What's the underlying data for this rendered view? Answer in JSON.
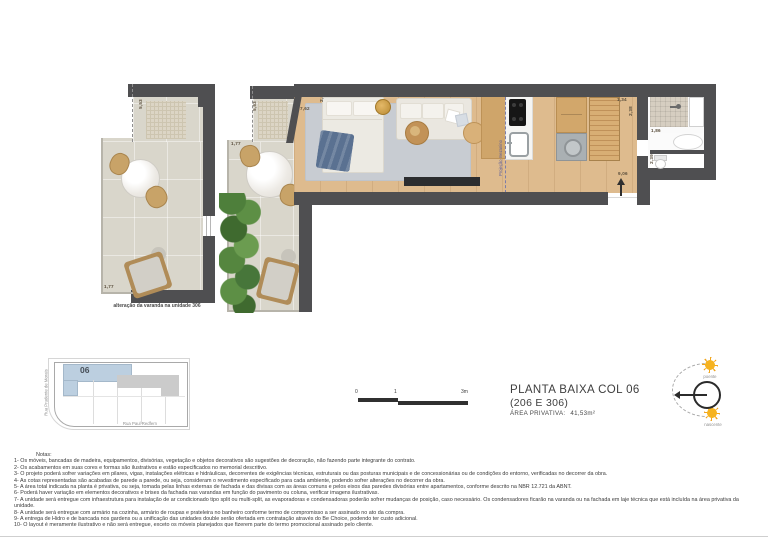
{
  "title_block": {
    "title": "PLANTA BAIXA COL 06",
    "subtitle": "(206 E 306)",
    "area_label": "ÁREA PRIVATIVA:",
    "area_value": "41,53m²"
  },
  "scale_bar": {
    "zero": "0",
    "one": "1",
    "three": "3m"
  },
  "compass": {
    "top_label": "poente",
    "bottom_label": "nascente"
  },
  "site_plan": {
    "unit": "06",
    "street_left": "Rua Prudente de Morais",
    "street_bottom": "Rua Paul Redfern"
  },
  "plan": {
    "balcony_306_caption": "alteração da varanda na unidade 306",
    "mezzanine_label": "Projeção mezanino",
    "dims": {
      "balcony306_depth": "5,53",
      "balcony306_width": "1,77",
      "balcony206_depth": "5,53",
      "balcony206_width": "1,77",
      "living_length": "7,62",
      "living_width": "2,43",
      "bath_width": "1,34",
      "bath_depth": "2,38",
      "vanity_length": "1,86",
      "wc_depth": "2,39",
      "total_length": "9,06"
    }
  },
  "notes": {
    "heading": "Notas:",
    "items": [
      "1- Os móveis, bancadas de madeira, equipamentos, divisórias, vegetação e objetos decorativos são sugestões de decoração, não fazendo parte integrante do contrato.",
      "2- Os acabamentos em suas cores e formas são ilustrativos e estão especificados no memorial descritivo.",
      "3- O projeto poderá sofrer variações em pilares, vigas, instalações elétricas e hidráulicas, decorrentes de exigências técnicas, estruturais ou das posturas municipais e de concessionárias ou de condições do entorno, verificadas no decorrer da obra.",
      "4- As cotas representadas são acabadas de parede a parede, ou seja, consideram o revestimento especificado para cada ambiente, podendo sofrer alterações no decorrer da obra.",
      "5- A área total indicada na planta é privativa, ou seja, tomada pelas linhas externas de fachada e das divisas com as áreas comuns e pelos eixos das paredes divisórias entre apartamentos, conforme descrito na NBR 12.721 da ABNT.",
      "6- Poderá haver variação em elementos decorativos e brises da fachada nas varandas em função do pavimento ou coluna, verificar imagens ilustrativas.",
      "7- A unidade será entregue com infraestrutura para instalação de ar condicionado tipo split ou multi-split, as evaporadoras e condensadoras poderão sofrer mudanças de posição, caso necessário. Os condensadores ficarão na varanda ou na fachada em laje técnica que está incluída na área privativa da unidade.",
      "8- A unidade será entregue com armário na cozinha, armário de roupas e prateleira no banheiro conforme termo de compromisso a ser assinado no ato da compra.",
      "9- A entrega de Hidro e de bancada nos gardens ou a unificação das unidades double serão ofertada em contratação através do Be Choice, podendo ter custo adicional.",
      "10- O layout é meramente ilustrativo e não será entregue, exceto os móveis planejados que fizerem parte do termo promocional assinado pelo cliente."
    ]
  },
  "colors": {
    "wall": "#4f4f51",
    "wood_floor": "#debb8e",
    "balcony_floor": "#d9d6cb",
    "rug": "#c8ccd2",
    "unit_highlight_blue": "#bccfe0",
    "sun_orange": "#f2a51c"
  }
}
